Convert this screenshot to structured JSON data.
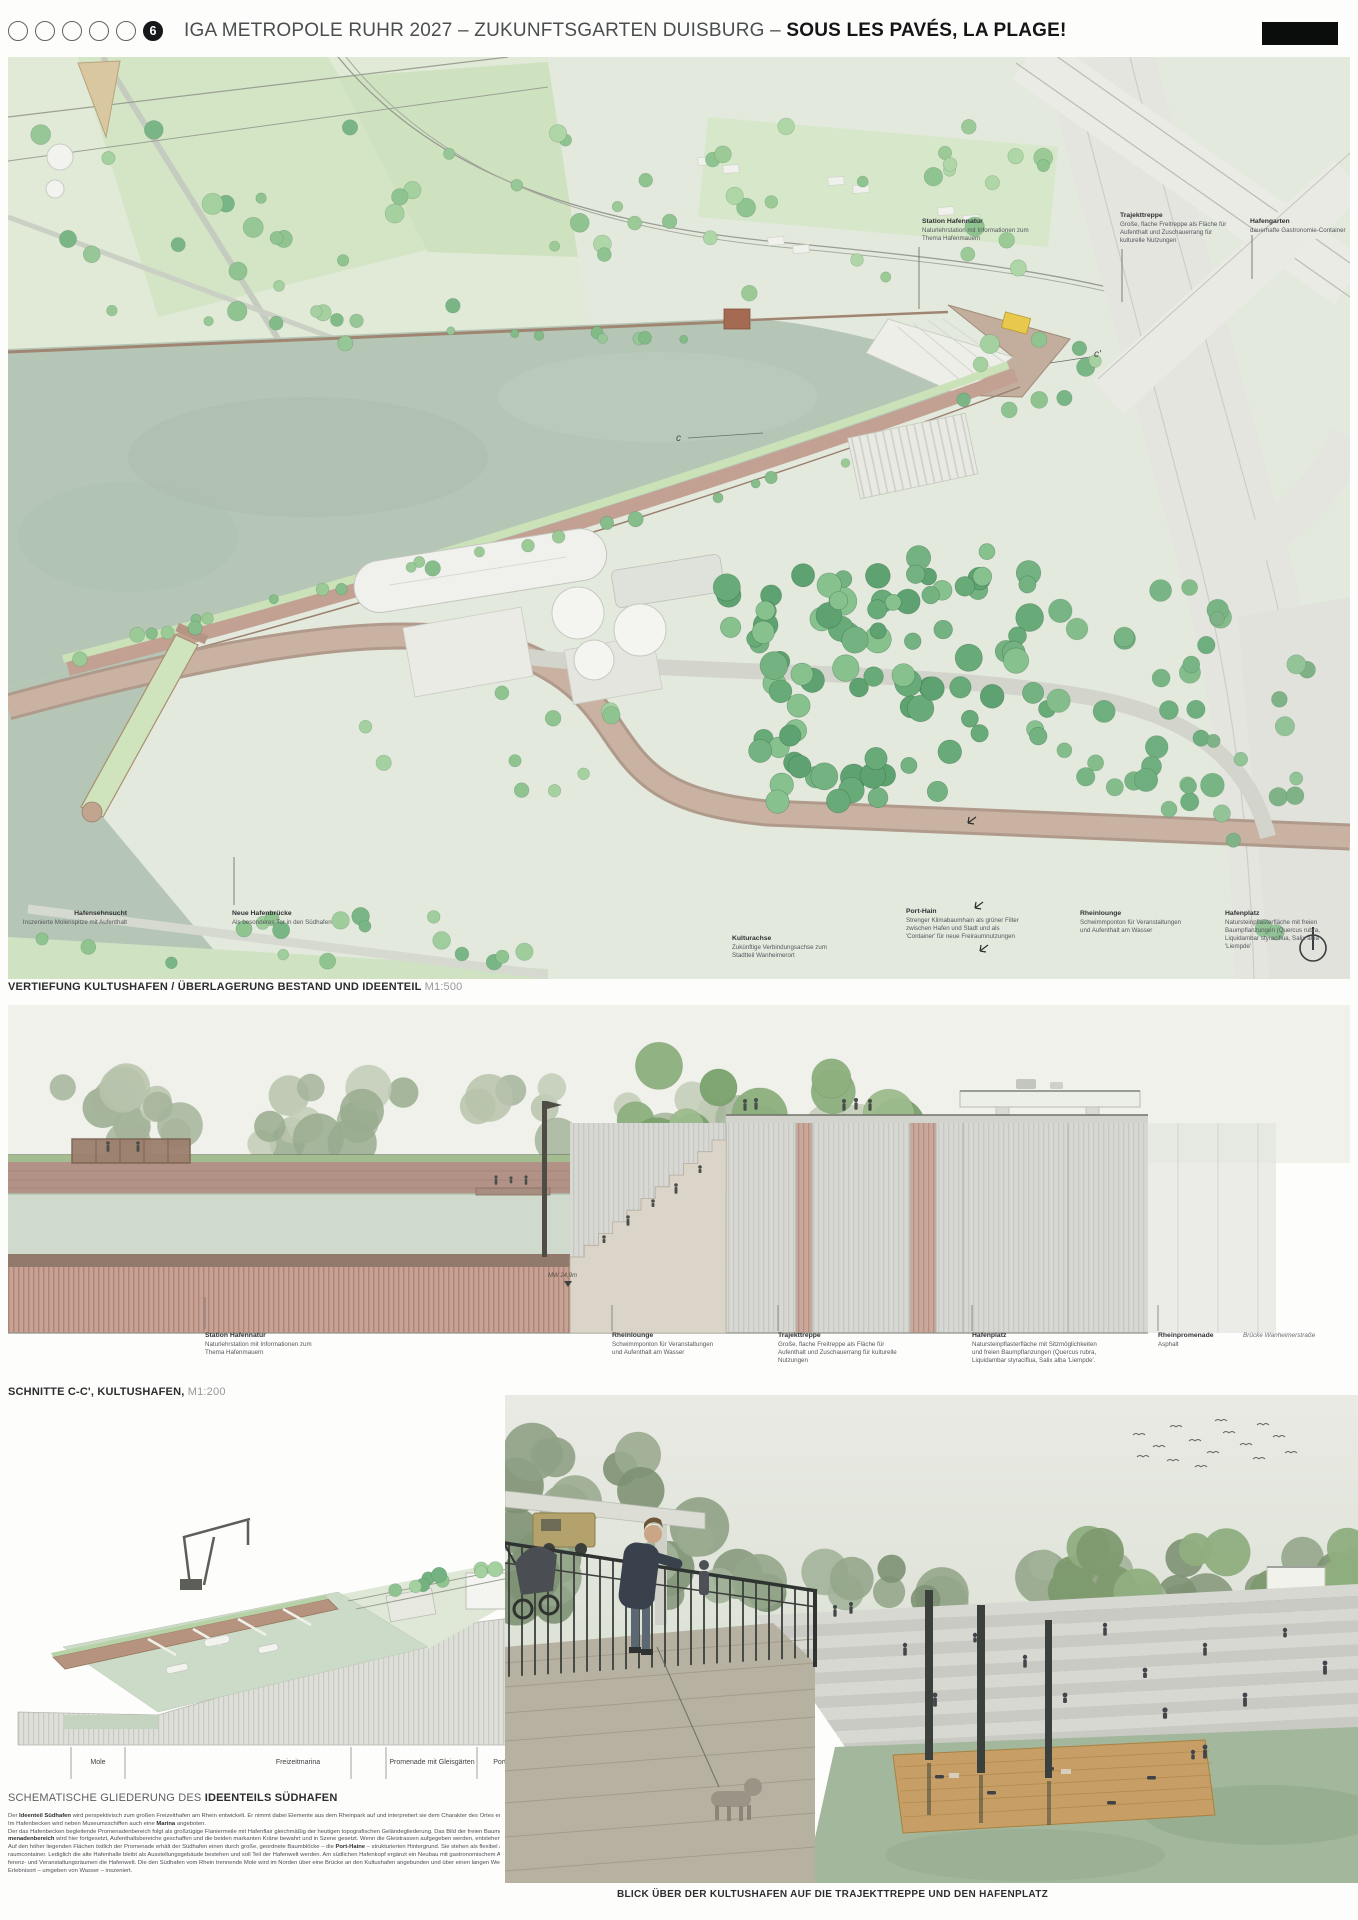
{
  "header": {
    "circle_count_empty": 5,
    "active_circle_number": "6",
    "title_regular": "IGA METROPOLE RUHR 2027 – ZUKUNFTSGARTEN DUISBURG – ",
    "title_bold": "SOUS LES PAVÉS, LA PLAGE!"
  },
  "plan": {
    "caption_bold": "VERTIEFUNG KULTUSHAFEN / ÜBERLAGERUNG BESTAND UND IDEENTEIL",
    "caption_scale": "M1:500",
    "marker_c": "c",
    "marker_c2": "c'",
    "labels": [
      {
        "title": "Station Hafennatur",
        "desc": "Naturlehrstation mit Informationen zum Thema Hafenmauern"
      },
      {
        "title": "Trajekttreppe",
        "desc": "Große, flache Freitreppe als Fläche für Aufenthalt und Zuschauerrang für kulturelle Nutzungen"
      },
      {
        "title": "Hafengarten",
        "desc": "dauerhafte Gastronomie-Container"
      },
      {
        "title": "Hafensehnsucht",
        "desc": "Inszenierte Molenspitze mit Aufenthalt"
      },
      {
        "title": "Neue Hafenbrücke",
        "desc": "Als besonderes Tor in den Südhafen"
      },
      {
        "title": "Kulturachse",
        "desc": "Zukünftige Verbindungsachse zum Stadtteil Wanheimerort"
      },
      {
        "title": "Port-Hain",
        "desc": "Strenger Klimabaumhain als grüner Filter zwischen Hafen und Stadt und als 'Container' für neue Freiraumnutzungen"
      },
      {
        "title": "Rheinlounge",
        "desc": "Schwimmponton für Veranstaltungen und Aufenthalt am Wasser"
      },
      {
        "title": "Hafenplatz",
        "desc": "Natursteinpflasterfläche mit freien Baumpflanzungen (Quercus rubra, Liquidambar styraciflua, Salix alba 'Liempde'"
      }
    ]
  },
  "section": {
    "caption_bold": "SCHNITTE C-C', KULTUSHAFEN,",
    "caption_scale": "M1:200",
    "water_level": "MW 24,9m",
    "labels": [
      {
        "title": "Station Hafennatur",
        "desc": "Naturlehrstation mit Informationen zum Thema Hafenmauern"
      },
      {
        "title": "Rheinlounge",
        "desc": "Schwimmponton für Veranstaltungen und Aufenthalt am Wasser"
      },
      {
        "title": "Trajekttreppe",
        "desc": "Große, flache Freitreppe als Fläche für Aufenthalt und Zuschauerrang für kulturelle Nutzungen"
      },
      {
        "title": "Hafenplatz",
        "desc": "Natursteinpflasterfläche mit Sitzmöglichkeiten und freien Baumpflanzungen (Quercus rubra, Liquidambar styraciflua, Salix alba 'Liempde'."
      },
      {
        "title": "Rheinpromenade",
        "desc": "Asphalt"
      },
      {
        "title_italic": "Brücke Wanheimerstraße"
      }
    ]
  },
  "axon": {
    "caption_regular": "SCHEMATISCHE GLIEDERUNG DES ",
    "caption_bold": "IDEENTEILS SÜDHAFEN",
    "zones": [
      "Mole",
      "Freizeitmarina",
      "Promenade mit Gleisgärten",
      "Port-Haine"
    ]
  },
  "body_text": {
    "lines": [
      "Der **Ideenteil Südhafen** wird perspektivisch zum großen Freizeithafen am Rhein entwickelt. Er nimmt dabei Elemente aus dem Rheinpark auf und interpretiert sie dem Charakter des Ortes entsprechend neu.",
      "Im Hafenbecken wird neben Museumsschiffen auch eine **Marina** angeboten.",
      "Der das Hafenbecken begleitende Promenadenbereich folgt als großzügige Flaniermeile mit Hafenflair gleichmäßig der heutigen topografischen Geländegliederung. Das Bild der freien Baumgruppen im **Pro-**",
      "**menadenbereich** wird hier fortgesetzt, Aufenthaltsbereiche geschaffen und die beiden markanten Kräne bewahrt und in Szene gesetzt. Wenn die Gleistrassen aufgegeben werden, entstehen hier Gleisgärten.",
      "Auf den höher liegenden Flächen östlich der Promenade erhält der Südhafen einen durch große, geordnete Baumblöcke – die **Port-Haine** – strukturierten Hintergrund. Sie stehen als flexibel aufteilbare Frei-",
      "raumcontainer. Lediglich die alte Hafenhalle bleibt als Ausstellungsgebäude bestehen und soll Teil der Hafenwelt werden. Am südlichen Hafenkopf ergänzt ein Neubau mit gastronomischem Angebot, Kon-",
      "ferenz- und Veranstaltungsräumen die Hafenwelt. Die den Südhafen vom Rhein trennende Mole wird im Norden über eine Brücke an den Kultushafen angebunden und über einen langen Weg als besonderer",
      "Erlebnisort – umgeben von Wasser – inszeniert."
    ]
  },
  "render": {
    "caption": "BLICK ÜBER DER KULTUSHAFEN AUF DIE TRAJEKTTREPPE UND DEN HAFENPLATZ"
  },
  "colors": {
    "water": "#b5c6b6",
    "land": "#e4e9df",
    "tree_green": "#74b381",
    "quay_brown": "#c2a193",
    "brick": "#b29287",
    "wall_gray": "#d7d8d3",
    "accent_yellow": "#e8c94d",
    "ink": "#2b2d2f"
  }
}
